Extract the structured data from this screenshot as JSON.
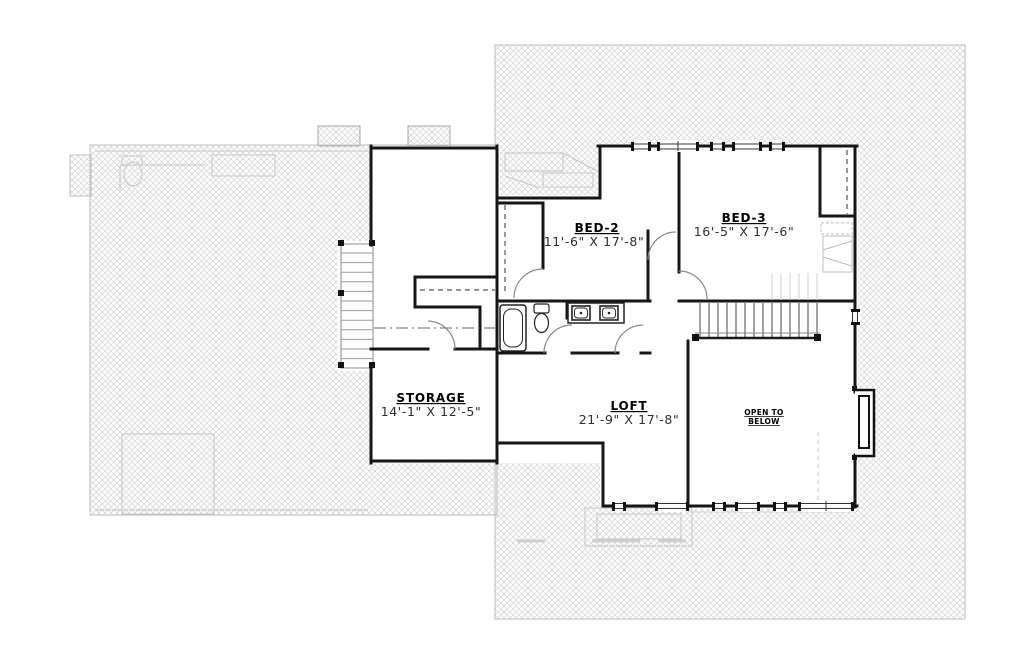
{
  "page": {
    "title": "Second Floor Plan",
    "background": "#ffffff"
  },
  "drawing": {
    "type": "architectural-floor-plan",
    "colors": {
      "wall": "#161616",
      "hatch_line": "#d9d9d9",
      "hatch_border": "#bdbdbd",
      "ghost": "#c6c6c6",
      "room_text": "#000000",
      "dim_text": "#2e2e2e"
    },
    "rooms": {
      "bed2": {
        "name": "BED-2",
        "dims": "11'-6\" X 17'-8\""
      },
      "bed3": {
        "name": "BED-3",
        "dims": "16'-5\" X 17'-6\""
      },
      "storage": {
        "name": "STORAGE",
        "dims": "14'-1\" X 12'-5\""
      },
      "loft": {
        "name": "LOFT",
        "dims": "21'-9\" X 17'-8\""
      },
      "open_to_below": {
        "line1": "OPEN TO",
        "line2": "BELOW"
      }
    },
    "features": [
      "upper-stairs",
      "stair-railing",
      "bathtub",
      "toilet",
      "double-vanity",
      "closets-with-rods",
      "bay-window",
      "windows",
      "cross-hatched-roof-areas",
      "ghosted-floor-below"
    ]
  }
}
